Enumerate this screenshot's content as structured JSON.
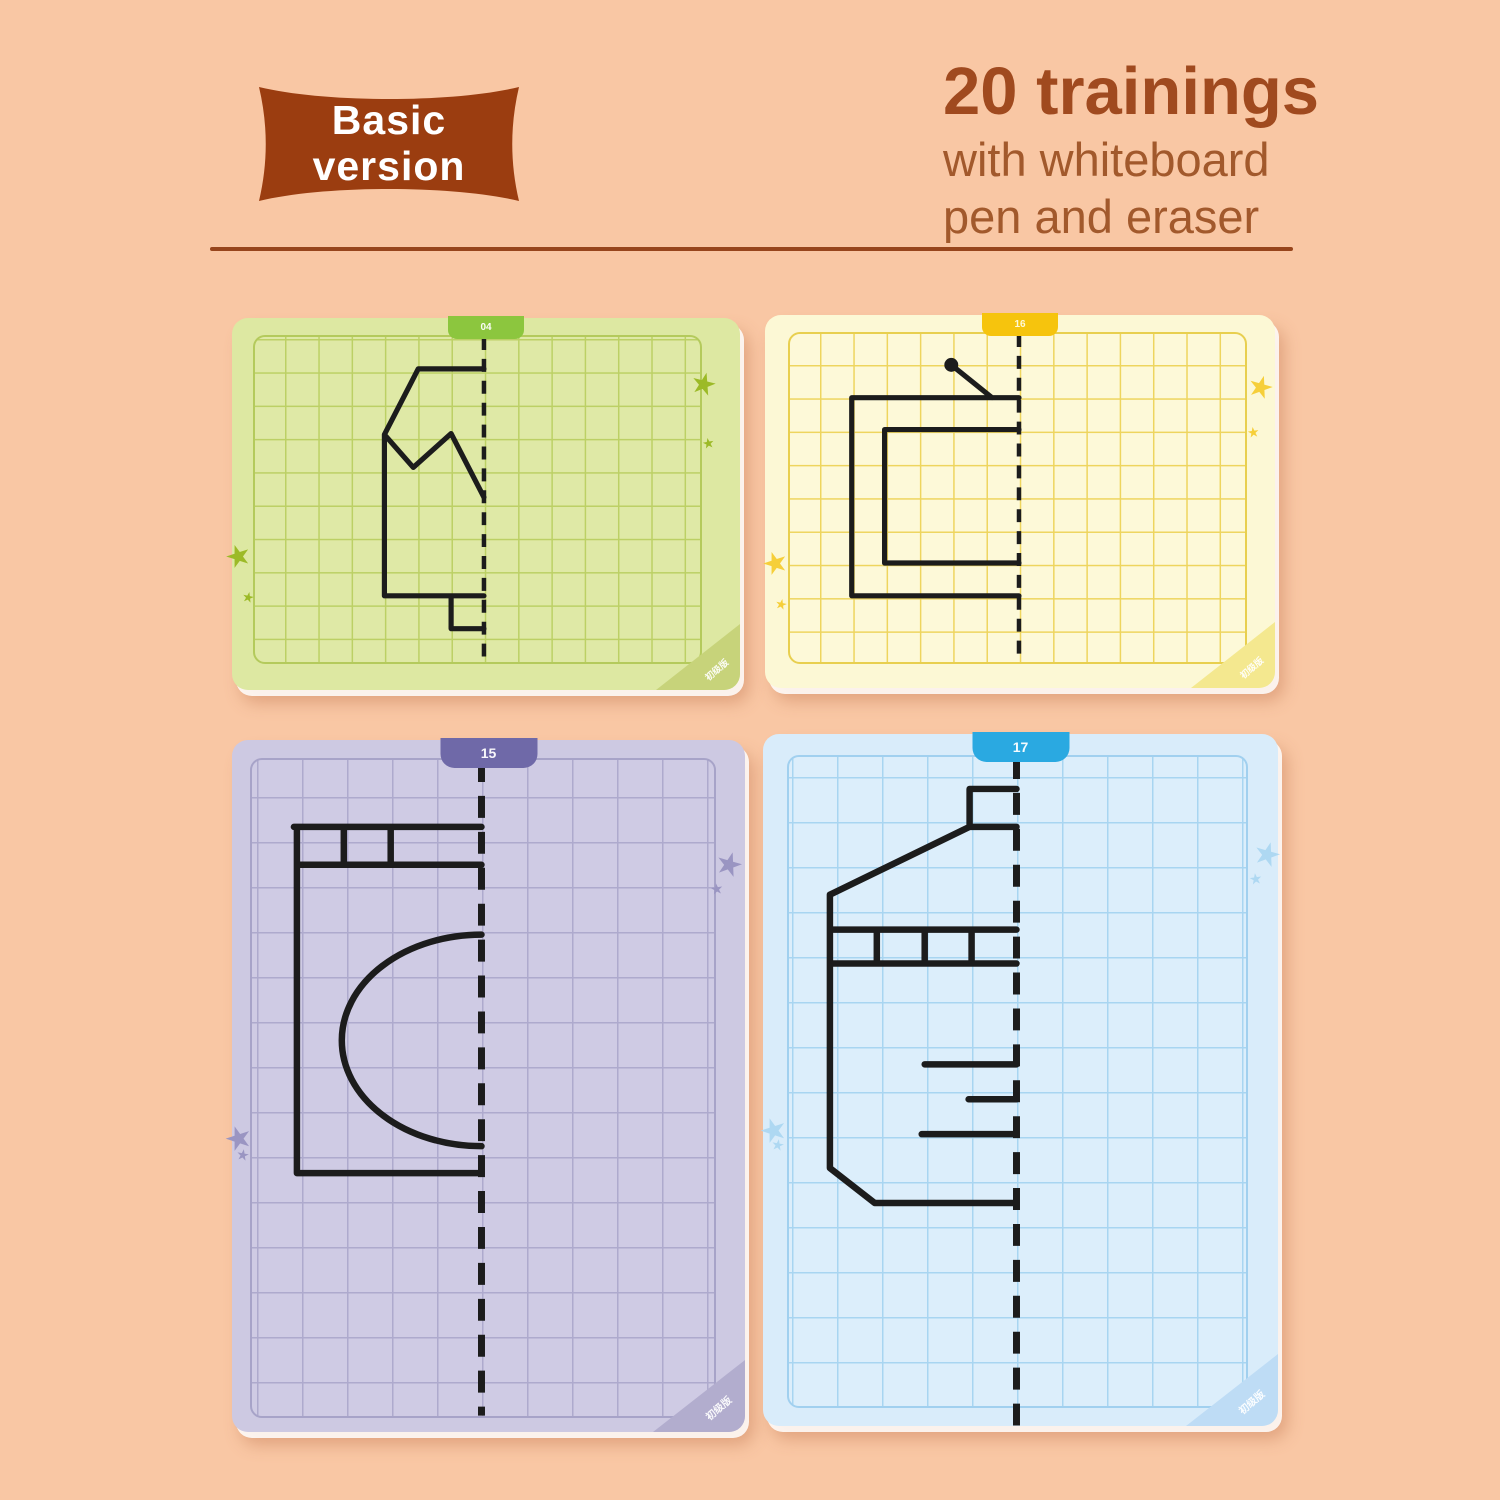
{
  "page": {
    "background_color": "#f9c7a4"
  },
  "badge": {
    "line1": "Basic",
    "line2": "version",
    "pillow_color": "#9b3d10",
    "text_color": "#ffffff"
  },
  "headline": {
    "title": "20 trainings",
    "subtitle_lines": [
      "with whiteboard",
      "pen and eraser"
    ],
    "title_color": "#a04a1f",
    "subtitle_color": "#a2592c"
  },
  "divider": {
    "color": "#97451c"
  },
  "cards": [
    {
      "id": "card-green",
      "tab_number": "04",
      "corner_label": "初级版",
      "drawing": "jacket-half",
      "card_color": "#dde8a2",
      "grid_line_color": "#bcd065",
      "tab_color": "#8cc63e",
      "star_color": "#9cba27"
    },
    {
      "id": "card-yellow",
      "tab_number": "16",
      "corner_label": "初级版",
      "drawing": "television-half",
      "card_color": "#fcf8d5",
      "grid_line_color": "#eed55e",
      "tab_color": "#f6c40d",
      "star_color": "#f6cf3a"
    },
    {
      "id": "card-purple",
      "tab_number": "15",
      "corner_label": "初级版",
      "drawing": "washing-machine-half",
      "card_color": "#cdc9e2",
      "grid_line_color": "#aeaacd",
      "tab_color": "#6f69a8",
      "star_color": "#9a95c2"
    },
    {
      "id": "card-blue",
      "tab_number": "17",
      "corner_label": "初级版",
      "drawing": "bottle-half",
      "card_color": "#d9ecfa",
      "grid_line_color": "#a8d5f1",
      "tab_color": "#2aa9e1",
      "star_color": "#aed8f2"
    }
  ]
}
